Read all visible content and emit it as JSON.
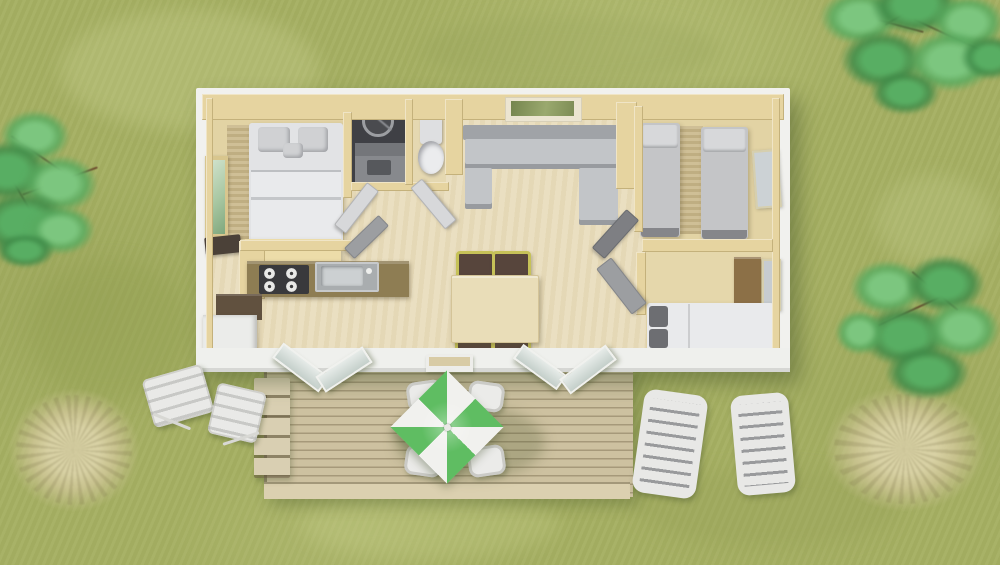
{
  "colors": {
    "grass": "#a5af62",
    "wall_white": "#f1f1ee",
    "wall_beige": "#e6d4a0",
    "front_wall": "#eff0ed",
    "floor": "#e9ddbd",
    "floor_tan": "#e2d3a4",
    "carpet": "#cbba8d",
    "deck": "#cdc1a0",
    "deck_rim": "#dbd0b0",
    "stair": "#d9cfb2",
    "bed_white": "#e2e3e5",
    "bed_gray": "#c4c5c7",
    "sofa": "#c2c5c8",
    "counter": "#8e7d53",
    "stove": "#39393c",
    "steel": "#a9adaf",
    "fridge": "#ebecea",
    "shower": "#3f4045",
    "toilet_green": "#b3c5a2",
    "table": "#e9ddb8",
    "chair_frame": "#c6c258",
    "chair_seat": "#57453c",
    "wardrobe": "#8c7047",
    "umb_green": "#5fbd62",
    "umb_white": "#f1f1ee",
    "patio_white": "#ebebe9",
    "lounger": "#e8e8e6",
    "branch": "#6f4f30",
    "dry_grass": "#d8d1a4"
  },
  "scene": {
    "type": "top-down 3D render of a mobile-home floor plan on a lawn",
    "environment": [
      "grass lawn",
      "tree top-left",
      "tree top-right",
      "bush right",
      "dry-grass tuft bottom-left",
      "dry-grass tuft bottom-right"
    ],
    "building": {
      "rooms": [
        "master bedroom",
        "shower room",
        "wc",
        "kitchen",
        "living-dining room",
        "twin bedroom",
        "second bedroom"
      ],
      "furniture": [
        "double bed",
        "wardrobe mirror",
        "kitchen counter with hob and sink",
        "fridge cabinet",
        "u-shaped sofa",
        "dining table with four chairs",
        "two single beds",
        "single bed",
        "wardrobe",
        "toilet",
        "shower",
        "vanity sink"
      ]
    },
    "terrace": [
      "wood deck",
      "steps",
      "green-white pinwheel parasol",
      "four patio chairs",
      "two sun loungers",
      "two folding chairs",
      "open sliding glass doors"
    ]
  }
}
